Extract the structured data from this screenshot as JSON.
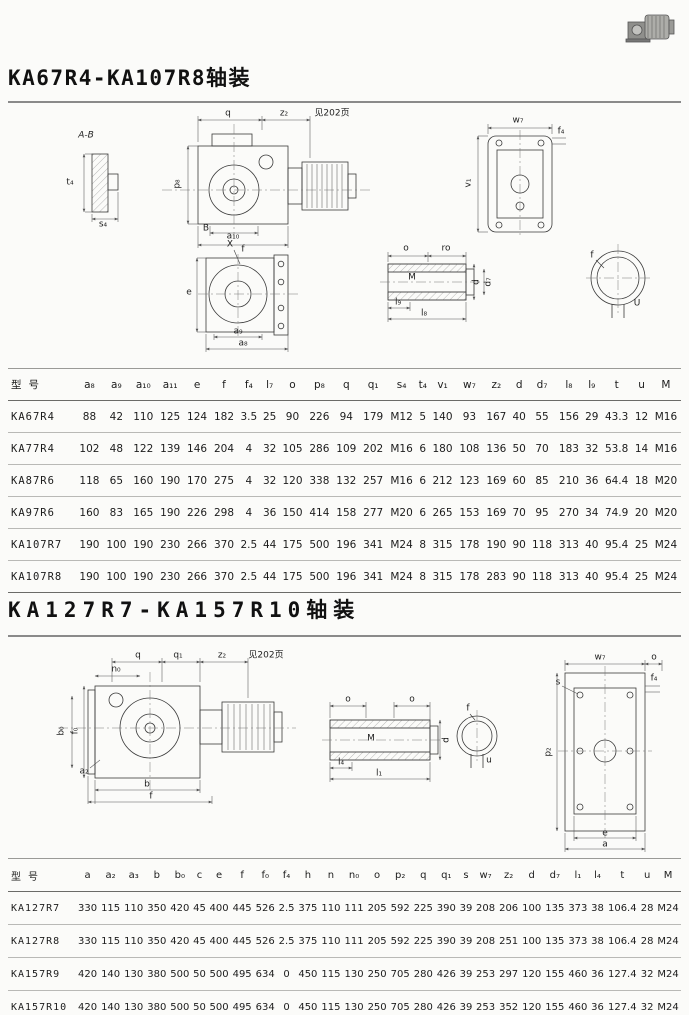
{
  "page": {
    "title1": "KA67R4-KA107R8轴装",
    "title2": "KA127R7-KA157R10轴装"
  },
  "drawing1": {
    "labels": [
      {
        "t": "A-B",
        "x": 86,
        "y": 30,
        "i": 1
      },
      {
        "t": "t₄",
        "x": 70,
        "y": 77
      },
      {
        "t": "s₄",
        "x": 103,
        "y": 119
      },
      {
        "t": "q",
        "x": 228,
        "y": 8
      },
      {
        "t": "z₂",
        "x": 284,
        "y": 8
      },
      {
        "t": "见202页",
        "x": 332,
        "y": 8
      },
      {
        "t": "p₈",
        "x": 178,
        "y": 78,
        "r": 1
      },
      {
        "t": "B",
        "x": 206,
        "y": 123
      },
      {
        "t": "a₁₀",
        "x": 233,
        "y": 131
      },
      {
        "t": "f",
        "x": 243,
        "y": 144
      },
      {
        "t": "w₇",
        "x": 518,
        "y": 15
      },
      {
        "t": "f₄",
        "x": 561,
        "y": 26
      },
      {
        "t": "v₁",
        "x": 469,
        "y": 77,
        "r": 1
      },
      {
        "t": "X",
        "x": 230,
        "y": 139
      },
      {
        "t": "e",
        "x": 189,
        "y": 187
      },
      {
        "t": "a₉",
        "x": 238,
        "y": 226
      },
      {
        "t": "a₈",
        "x": 243,
        "y": 238
      },
      {
        "t": "o",
        "x": 406,
        "y": 143
      },
      {
        "t": "ro",
        "x": 446,
        "y": 143
      },
      {
        "t": "M",
        "x": 412,
        "y": 172
      },
      {
        "t": "d",
        "x": 477,
        "y": 176,
        "r": 1
      },
      {
        "t": "d₇",
        "x": 489,
        "y": 176,
        "r": 1
      },
      {
        "t": "l₉",
        "x": 398,
        "y": 197
      },
      {
        "t": "l₈",
        "x": 424,
        "y": 208
      },
      {
        "t": "f",
        "x": 592,
        "y": 150
      },
      {
        "t": "U",
        "x": 637,
        "y": 198
      }
    ]
  },
  "drawing2": {
    "labels": [
      {
        "t": "q",
        "x": 138,
        "y": 8
      },
      {
        "t": "q₁",
        "x": 178,
        "y": 8
      },
      {
        "t": "z₂",
        "x": 222,
        "y": 8
      },
      {
        "t": "见202页",
        "x": 266,
        "y": 8
      },
      {
        "t": "n₀",
        "x": 116,
        "y": 22
      },
      {
        "t": "b₀",
        "x": 62,
        "y": 83,
        "r": 1
      },
      {
        "t": "f₀",
        "x": 76,
        "y": 83,
        "r": 1
      },
      {
        "t": "a₂",
        "x": 84,
        "y": 124
      },
      {
        "t": "b",
        "x": 147,
        "y": 137
      },
      {
        "t": "f",
        "x": 151,
        "y": 149
      },
      {
        "t": "o",
        "x": 348,
        "y": 52
      },
      {
        "t": "o",
        "x": 412,
        "y": 52
      },
      {
        "t": "M",
        "x": 371,
        "y": 91
      },
      {
        "t": "d",
        "x": 447,
        "y": 92,
        "r": 1
      },
      {
        "t": "l₄",
        "x": 341,
        "y": 115
      },
      {
        "t": "l₁",
        "x": 379,
        "y": 126
      },
      {
        "t": "f",
        "x": 468,
        "y": 61
      },
      {
        "t": "u",
        "x": 489,
        "y": 113
      },
      {
        "t": "w₇",
        "x": 600,
        "y": 10
      },
      {
        "t": "o",
        "x": 654,
        "y": 10
      },
      {
        "t": "s",
        "x": 558,
        "y": 35
      },
      {
        "t": "f₄",
        "x": 654,
        "y": 31
      },
      {
        "t": "p₂",
        "x": 549,
        "y": 104,
        "r": 1
      },
      {
        "t": "e",
        "x": 605,
        "y": 186
      },
      {
        "t": "a",
        "x": 605,
        "y": 197
      }
    ]
  },
  "table1": {
    "model_header": "型号",
    "columns": [
      "a₈",
      "a₉",
      "a₁₀",
      "a₁₁",
      "e",
      "f",
      "f₄",
      "l₇",
      "o",
      "p₈",
      "q",
      "q₁",
      "s₄",
      "t₄",
      "v₁",
      "w₇",
      "z₂",
      "d",
      "d₇",
      "l₈",
      "l₉",
      "t",
      "u",
      "M"
    ],
    "rows": [
      {
        "model": "KA67R4",
        "values": [
          88,
          42,
          110,
          125,
          124,
          182,
          3.5,
          25,
          90,
          226,
          94,
          179,
          "M12",
          5,
          140,
          93,
          167,
          40,
          55,
          156,
          29,
          43.3,
          12,
          "M16"
        ]
      },
      {
        "model": "KA77R4",
        "values": [
          102,
          48,
          122,
          139,
          146,
          204,
          4,
          32,
          105,
          286,
          109,
          202,
          "M16",
          6,
          180,
          108,
          136,
          50,
          70,
          183,
          32,
          53.8,
          14,
          "M16"
        ]
      },
      {
        "model": "KA87R6",
        "values": [
          118,
          65,
          160,
          190,
          170,
          275,
          4,
          32,
          120,
          338,
          132,
          257,
          "M16",
          6,
          212,
          123,
          169,
          60,
          85,
          210,
          36,
          64.4,
          18,
          "M20"
        ]
      },
      {
        "model": "KA97R6",
        "values": [
          160,
          83,
          165,
          190,
          226,
          298,
          4,
          36,
          150,
          414,
          158,
          277,
          "M20",
          6,
          265,
          153,
          169,
          70,
          95,
          270,
          34,
          74.9,
          20,
          "M20"
        ]
      },
      {
        "model": "KA107R7",
        "values": [
          190,
          100,
          190,
          230,
          266,
          370,
          2.5,
          44,
          175,
          500,
          196,
          341,
          "M24",
          8,
          315,
          178,
          190,
          90,
          118,
          313,
          40,
          95.4,
          25,
          "M24"
        ]
      },
      {
        "model": "KA107R8",
        "values": [
          190,
          100,
          190,
          230,
          266,
          370,
          2.5,
          44,
          175,
          500,
          196,
          341,
          "M24",
          8,
          315,
          178,
          283,
          90,
          118,
          313,
          40,
          95.4,
          25,
          "M24"
        ]
      }
    ]
  },
  "table2": {
    "model_header": "型号",
    "columns": [
      "a",
      "a₂",
      "a₃",
      "b",
      "b₀",
      "c",
      "e",
      "f",
      "f₀",
      "f₄",
      "h",
      "n",
      "n₀",
      "o",
      "p₂",
      "q",
      "q₁",
      "s",
      "w₇",
      "z₂",
      "d",
      "d₇",
      "l₁",
      "l₄",
      "t",
      "u",
      "M"
    ],
    "rows": [
      {
        "model": "KA127R7",
        "values": [
          330,
          115,
          110,
          350,
          420,
          45,
          400,
          445,
          526,
          2.5,
          375,
          110,
          111,
          205,
          592,
          225,
          390,
          39,
          208,
          206,
          100,
          135,
          373,
          38,
          106.4,
          28,
          "M24"
        ]
      },
      {
        "model": "KA127R8",
        "values": [
          330,
          115,
          110,
          350,
          420,
          45,
          400,
          445,
          526,
          2.5,
          375,
          110,
          111,
          205,
          592,
          225,
          390,
          39,
          208,
          251,
          100,
          135,
          373,
          38,
          106.4,
          28,
          "M24"
        ]
      },
      {
        "model": "KA157R9",
        "values": [
          420,
          140,
          130,
          380,
          500,
          50,
          500,
          495,
          634,
          0,
          450,
          115,
          130,
          250,
          705,
          280,
          426,
          39,
          253,
          297,
          120,
          155,
          460,
          36,
          127.4,
          32,
          "M24"
        ]
      },
      {
        "model": "KA157R10",
        "values": [
          420,
          140,
          130,
          380,
          500,
          50,
          500,
          495,
          634,
          0,
          450,
          115,
          130,
          250,
          705,
          280,
          426,
          39,
          253,
          352,
          120,
          155,
          460,
          36,
          127.4,
          32,
          "M24"
        ]
      }
    ]
  }
}
